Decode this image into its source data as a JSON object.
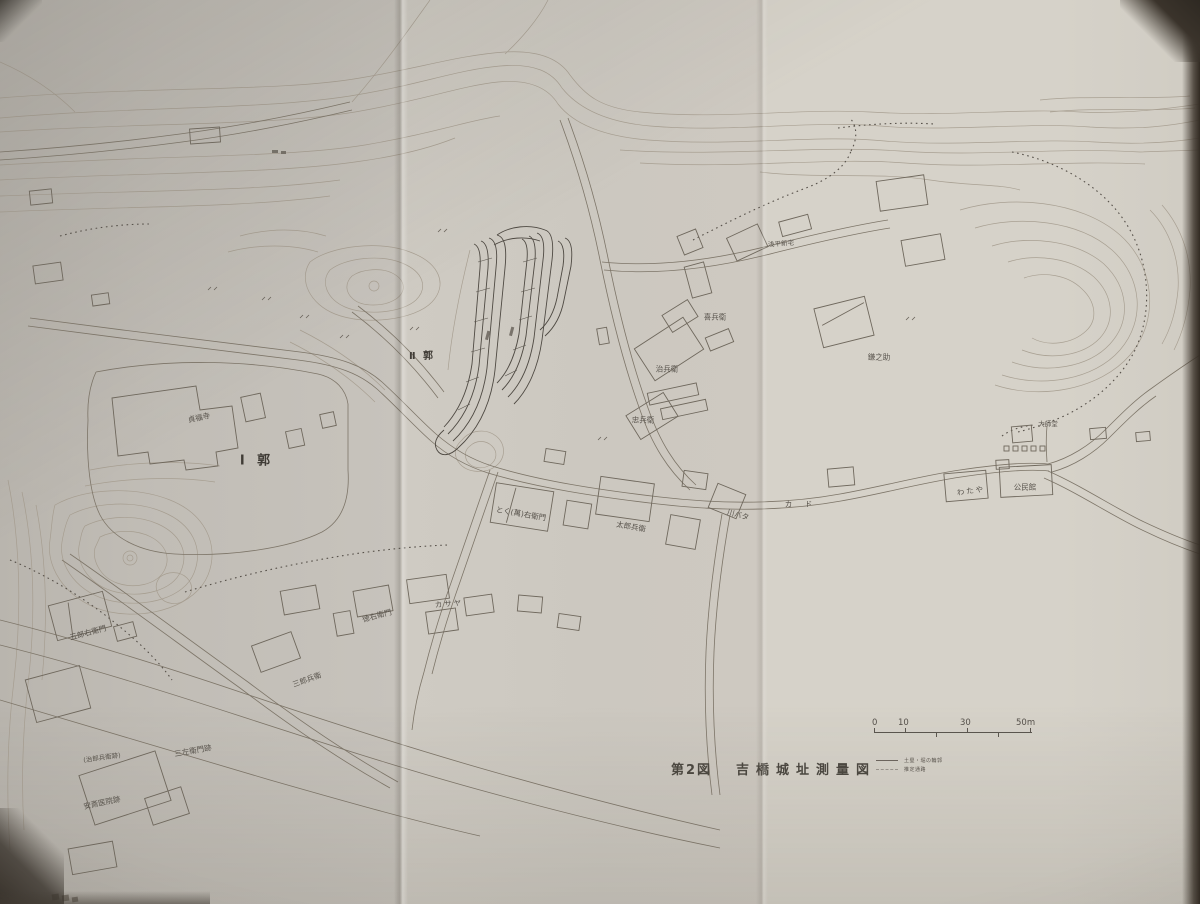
{
  "caption": {
    "figure_no": "第2図",
    "title": "吉橋城址測量図"
  },
  "scale_bar": {
    "tick_labels": [
      "0",
      "10",
      "30",
      "50m"
    ]
  },
  "legend": {
    "items": [
      {
        "label": "土塁・堀の輪郭",
        "line": "solid"
      },
      {
        "label": "推定通路",
        "line": "dashed"
      }
    ]
  },
  "map_labels": [
    {
      "text": "Ⅰ 郭",
      "x": 257,
      "y": 461,
      "size": 13,
      "rot": 0,
      "ls": 4,
      "big": true
    },
    {
      "text": "Ⅱ 郭",
      "x": 422,
      "y": 357,
      "size": 10,
      "rot": 0,
      "ls": 2,
      "big": true
    },
    {
      "text": "貞福寺",
      "x": 199,
      "y": 418,
      "size": 7.5,
      "rot": -12
    },
    {
      "text": "浅平新宅",
      "x": 781,
      "y": 244,
      "size": 6.5,
      "rot": -4
    },
    {
      "text": "喜兵衛",
      "x": 715,
      "y": 317,
      "size": 7.5,
      "rot": 0
    },
    {
      "text": "治兵衛",
      "x": 667,
      "y": 369,
      "size": 7.5,
      "rot": 0
    },
    {
      "text": "忠兵衛",
      "x": 643,
      "y": 420,
      "size": 7.5,
      "rot": 0
    },
    {
      "text": "鎌之助",
      "x": 879,
      "y": 357,
      "size": 7.5,
      "rot": 0
    },
    {
      "text": "大師堂",
      "x": 1048,
      "y": 424,
      "size": 6.5,
      "rot": 0
    },
    {
      "text": "わたや",
      "x": 971,
      "y": 491,
      "size": 7.5,
      "rot": -8,
      "ls": 2
    },
    {
      "text": "公民館",
      "x": 1025,
      "y": 487,
      "size": 7.5,
      "rot": 0
    },
    {
      "text": "カ ド",
      "x": 801,
      "y": 504,
      "size": 7.5,
      "rot": 0,
      "ls": 5
    },
    {
      "text": "川バタ",
      "x": 738,
      "y": 515,
      "size": 7.5,
      "rot": 15
    },
    {
      "text": "太郎兵衛",
      "x": 631,
      "y": 527,
      "size": 7.5,
      "rot": 10
    },
    {
      "text": "とく(萬)右衛門",
      "x": 521,
      "y": 514,
      "size": 7.5,
      "rot": 10
    },
    {
      "text": "カサヤ",
      "x": 449,
      "y": 604,
      "size": 7.5,
      "rot": -5,
      "ls": 2
    },
    {
      "text": "徳右衛門",
      "x": 377,
      "y": 616,
      "size": 7.5,
      "rot": -15
    },
    {
      "text": "三郎兵衛",
      "x": 307,
      "y": 680,
      "size": 7.5,
      "rot": -20
    },
    {
      "text": "五郎右衛門",
      "x": 88,
      "y": 633,
      "size": 7.5,
      "rot": -15
    },
    {
      "text": "三左衛門跡",
      "x": 193,
      "y": 751,
      "size": 7.5,
      "rot": -10
    },
    {
      "text": "(治郎兵衛跡)",
      "x": 102,
      "y": 758,
      "size": 6.5,
      "rot": -8
    },
    {
      "text": "安斎医院跡",
      "x": 102,
      "y": 803,
      "size": 7.5,
      "rot": -12
    }
  ]
}
